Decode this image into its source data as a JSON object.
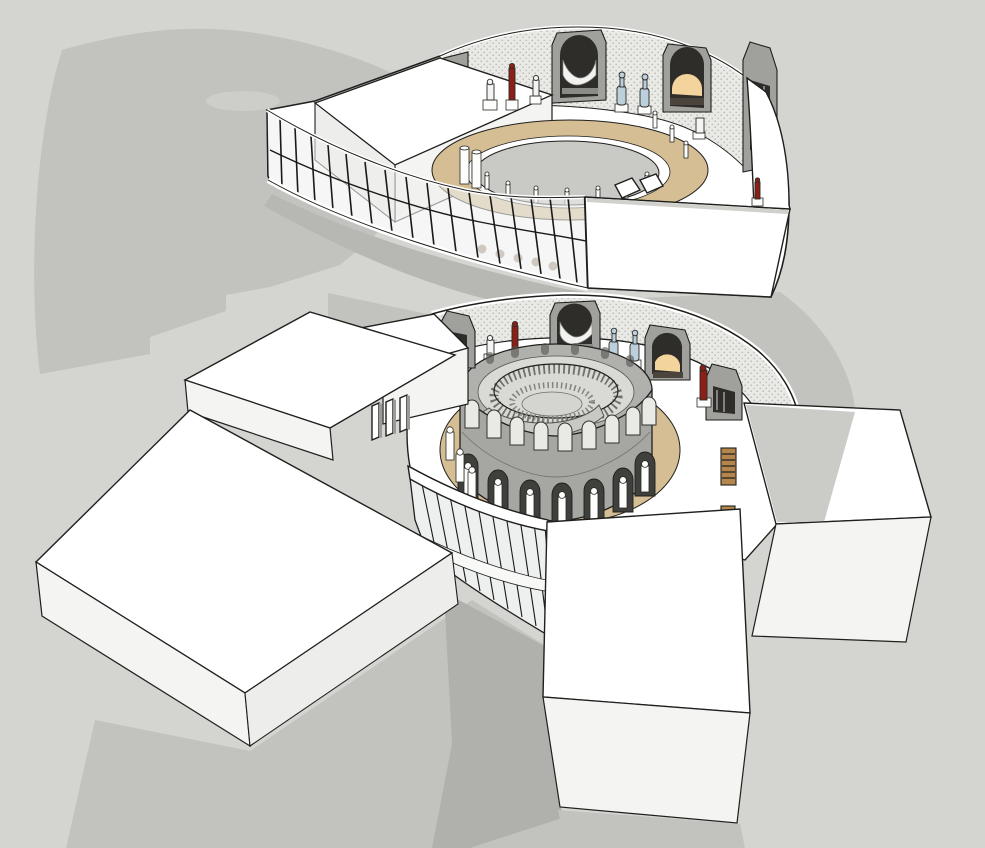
{
  "viewport": {
    "kind": "3d-architectural-model-view",
    "subject": "exploded axonometric of a circular museum gallery: detached upper-floor ring above, main building with central rotunda and four rectangular wings below"
  },
  "colors": {
    "background": "#d4d4d0",
    "shadow": "#c2c2be",
    "shadow_dark": "#b0b0ac",
    "shadow_under": "#b7b7b3",
    "shadow_light": "#cdcdc9",
    "surface_white": "#ffffff",
    "surface_shaded": "#f3f3f1",
    "outline": "#1f1f1d",
    "glass": "#eef0ef",
    "mullion": "#1a1a18",
    "ring_tan": "#d5bd94",
    "oculus_gray": "#c9c9c5",
    "drum_wall": "#a6a6a2",
    "drum_inner": "#b0b0ac",
    "drum_opening": "#3f3f3c",
    "drum_floor": "#d9d9d5",
    "ramp": "#c8c8c4",
    "texture_base": "#e9e9e5",
    "texture_dot": "#b8b8b4",
    "niche_frame": "#a0a09c",
    "niche_void": "#2f2d2a",
    "niche_amber": "#f2d49c",
    "drapery": "#f2f2f0",
    "statue_red": "#8d2016",
    "statue_blue": "#bccfdb",
    "statue_white": "#f4f4f2",
    "bench_wood": "#b5854e",
    "bench_stripe": "#3a3028"
  },
  "scene": {
    "upper_piece": {
      "niche_count": 4,
      "glass_mullions": 16,
      "statues_red": 2,
      "statues_blue": 2,
      "statues_white": 6,
      "oculus_rim_posts": 11
    },
    "lower_building": {
      "wings": 4,
      "benches": 3,
      "niche_count": 4,
      "drum_upper_arches": 9,
      "drum_arcade_openings": 7,
      "statues_red": 2,
      "statues_blue": 2
    }
  }
}
